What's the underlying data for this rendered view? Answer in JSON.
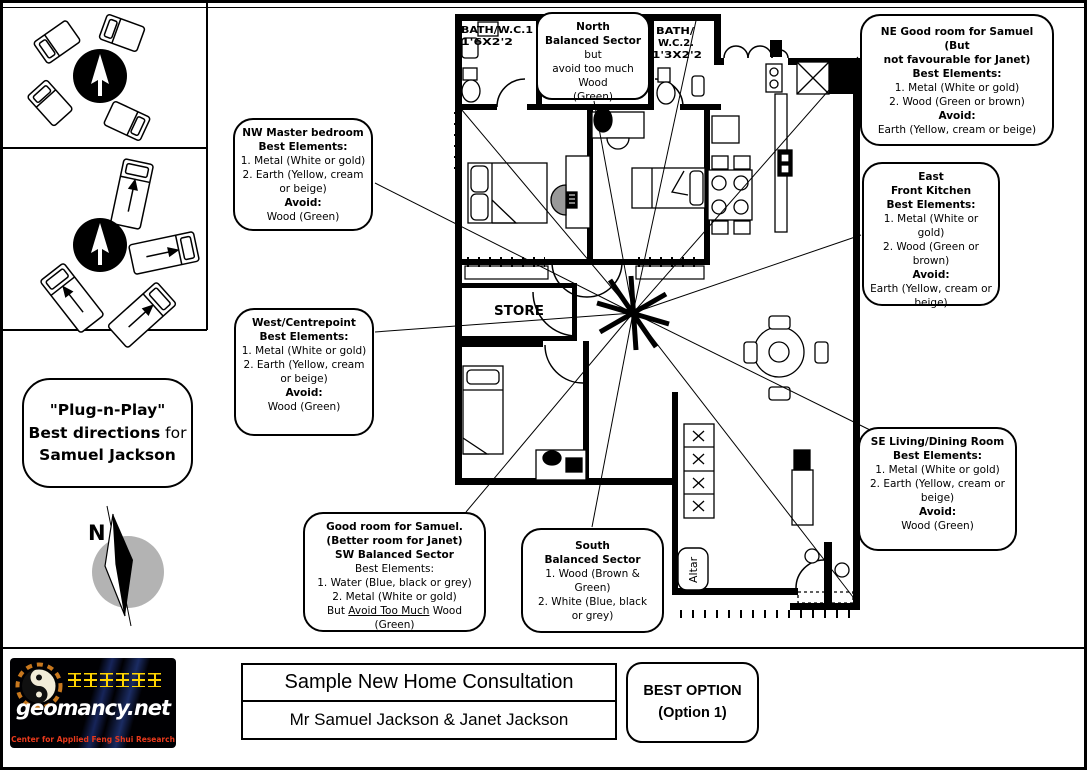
{
  "sidebar": {
    "plug_bubble": {
      "line1": "\"Plug-n-Play\"",
      "line2_bold": "Best directions",
      "line2_regular": " for",
      "line3": "Samuel Jackson"
    },
    "compass_label": "N"
  },
  "callouts": {
    "nw": {
      "title": "NW Master bedroom",
      "best_header": "Best Elements:",
      "item1": "1. Metal (White or gold)",
      "item2": "2. Earth (Yellow, cream or beige)",
      "avoid_header": "Avoid:",
      "avoid": "Wood (Green)"
    },
    "north": {
      "title": "North",
      "line2_bold": "Balanced Sector",
      "line2_rest": " but",
      "line3": "avoid too much Wood",
      "line4": "(Green)"
    },
    "ne": {
      "title_line1": "NE Good room for Samuel (But",
      "title_line2": "not favourable for Janet)",
      "best_header": "Best Elements:",
      "item1": "1. Metal (White or gold)",
      "item2": "2. Wood (Green or brown)",
      "avoid_header": "Avoid:",
      "avoid": "Earth (Yellow, cream or beige)"
    },
    "east": {
      "title_line1": "East",
      "title_line2": "Front Kitchen",
      "best_header": "Best Elements:",
      "item1": "1. Metal (White or gold)",
      "item2": "2. Wood (Green or brown)",
      "avoid_header": "Avoid:",
      "avoid": "Earth (Yellow, cream or beige)"
    },
    "west": {
      "title": "West/Centrepoint",
      "best_header": "Best Elements:",
      "item1": "1. Metal (White or gold)",
      "item2": "2. Earth (Yellow, cream or beige)",
      "avoid_header": "Avoid:",
      "avoid": "Wood (Green)"
    },
    "sw": {
      "title_line1": "Good room for Samuel.",
      "title_line2": "(Better room for Janet)",
      "title_line3": "SW Balanced Sector",
      "best_header": "Best Elements:",
      "item1": "1. Water (Blue, black or grey)",
      "item2": "2. Metal (White or gold)",
      "last_prefix": "But ",
      "last_underlined": "Avoid Too Much",
      "last_suffix": " Wood (Green)"
    },
    "south": {
      "title_line1": "South",
      "title_line2": "Balanced Sector",
      "item1": "1. Wood (Brown & Green)",
      "item2": "2. White (Blue, black or grey)"
    },
    "se": {
      "title": "SE Living/Dining Room",
      "best_header": "Best Elements:",
      "item1": "1. Metal (White or gold)",
      "item2": "2. Earth (Yellow, cream or beige)",
      "avoid_header": "Avoid:",
      "avoid": "Wood (Green)"
    }
  },
  "floorplan": {
    "labels": {
      "bath1_name": "BATH/W.C.1",
      "bath1_size": "1'6X2'2",
      "bath2_name": "BATH/",
      "bath2_wc": "W.C.2.",
      "bath2_size": "1'3X2'2",
      "store": "STORE",
      "altar": "Altar"
    }
  },
  "footer": {
    "logo": {
      "chinese": "风水研究中心",
      "brand": "geomancy.net",
      "tagline": "Center for Applied Feng Shui Research"
    },
    "title": "Sample New Home Consultation",
    "subtitle": "Mr Samuel Jackson & Janet Jackson",
    "best_option": {
      "line1": "BEST OPTION",
      "line2": "(Option 1)"
    }
  }
}
